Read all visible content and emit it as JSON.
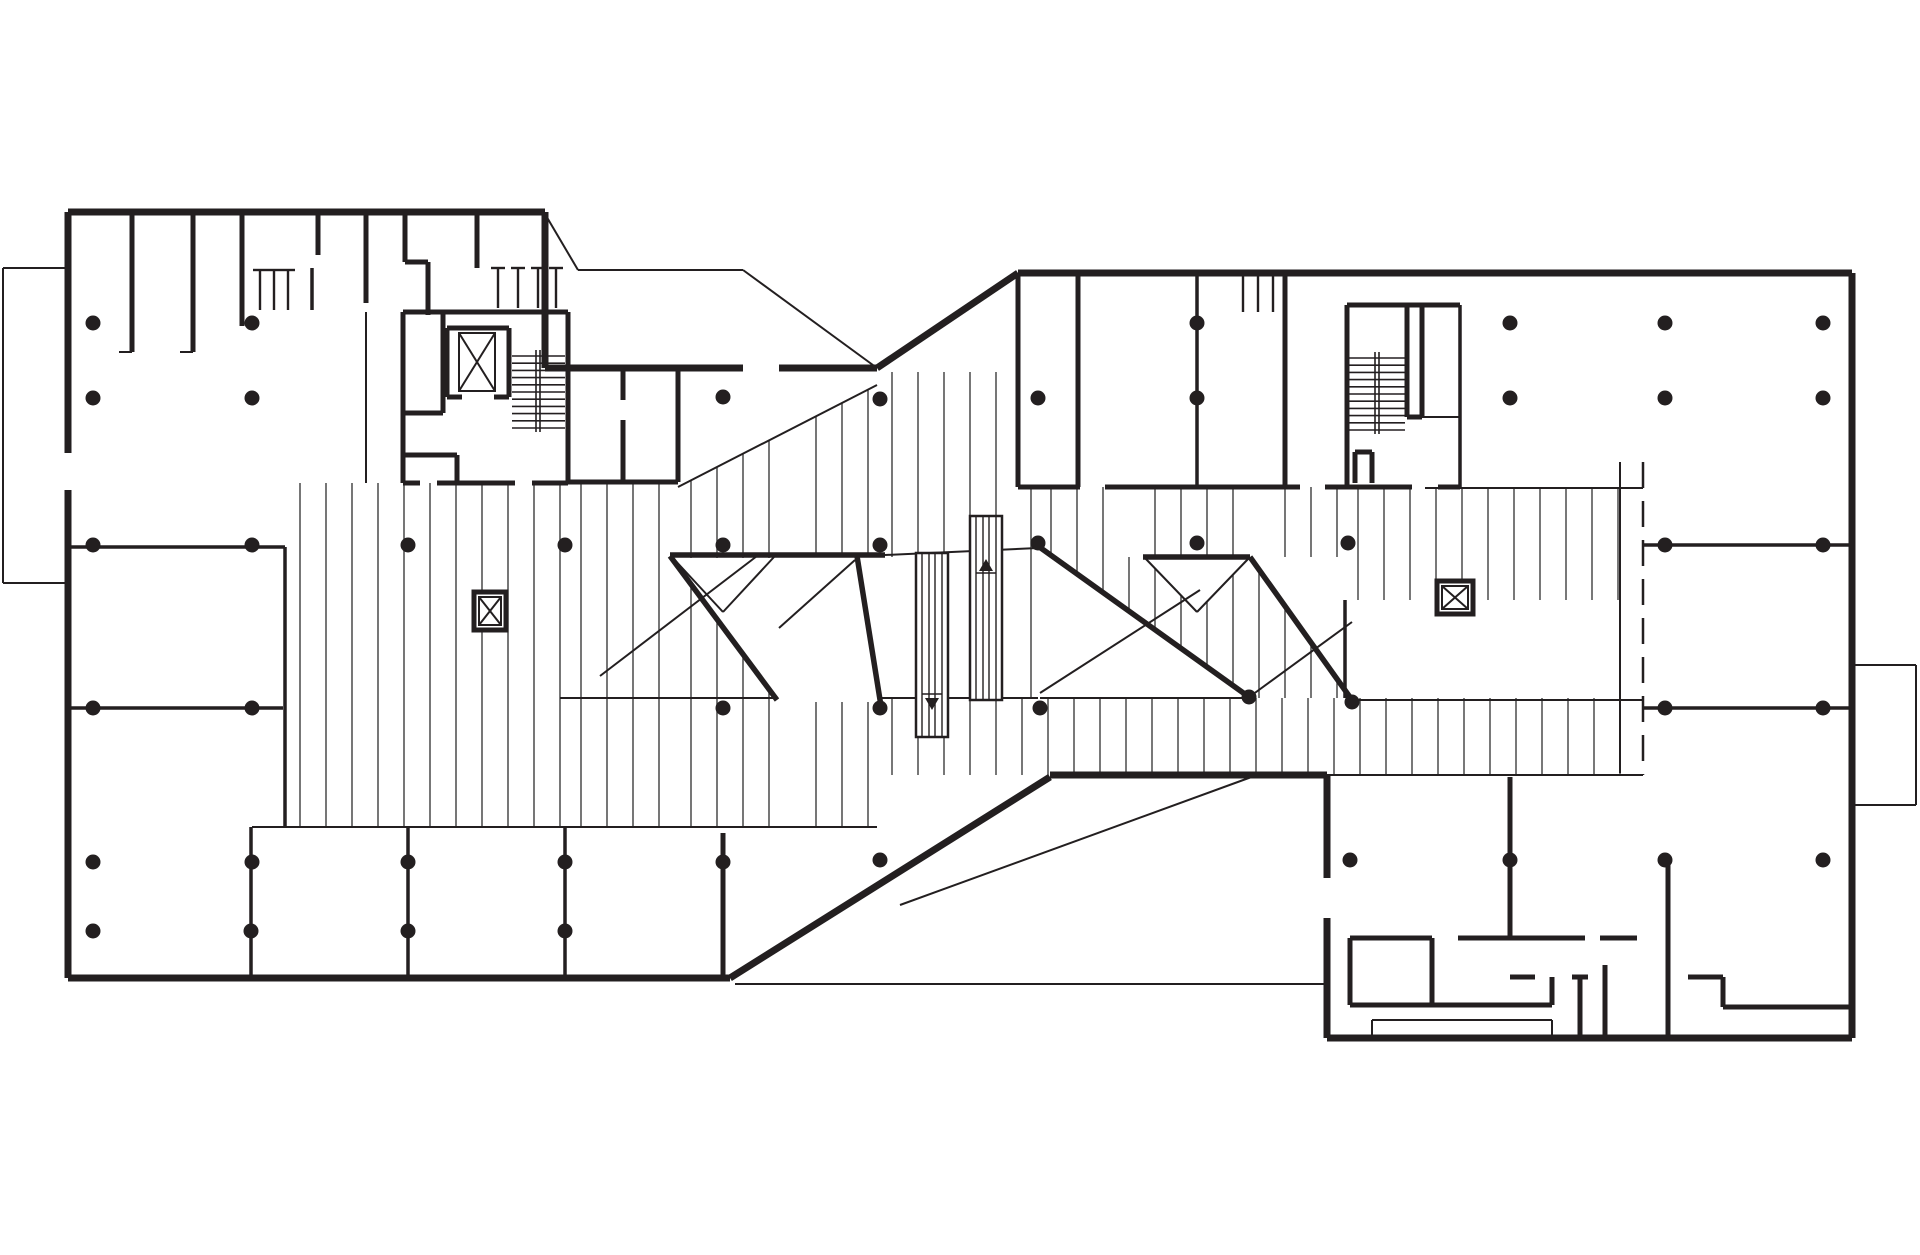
{
  "meta": {
    "title": "Building floor plan — parking level with ramp bands, two stair cores and service annex",
    "canvas": {
      "w": 1920,
      "h": 1255
    },
    "ink": "#231f20",
    "hatch_ink": "#3d3d3d",
    "bg": "#ffffff"
  },
  "plan": {
    "walls_thick": [
      [
        68,
        212,
        545,
        212
      ],
      [
        545,
        212,
        545,
        368
      ],
      [
        545,
        368,
        743,
        368
      ],
      [
        779,
        368,
        877,
        368
      ],
      [
        877,
        368,
        1018,
        273
      ],
      [
        1018,
        273,
        1852,
        273
      ],
      [
        1852,
        273,
        1852,
        1038
      ],
      [
        1327,
        1038,
        1852,
        1038
      ],
      [
        1327,
        918,
        1327,
        1038
      ],
      [
        1327,
        775,
        1327,
        878
      ],
      [
        1050,
        775,
        1327,
        775
      ],
      [
        730,
        978,
        1050,
        777
      ],
      [
        68,
        978,
        730,
        978
      ],
      [
        68,
        490,
        68,
        978
      ],
      [
        68,
        212,
        68,
        453
      ]
    ],
    "walls_medium": [
      [
        132,
        212,
        132,
        352
      ],
      [
        193,
        212,
        193,
        352
      ],
      [
        242,
        212,
        242,
        326
      ],
      [
        318,
        212,
        318,
        255
      ],
      [
        366,
        212,
        366,
        303
      ],
      [
        405,
        212,
        405,
        262
      ],
      [
        405,
        262,
        428,
        262
      ],
      [
        428,
        262,
        428,
        315
      ],
      [
        477,
        212,
        477,
        268
      ],
      [
        403,
        312,
        568,
        312
      ],
      [
        403,
        312,
        403,
        483
      ],
      [
        568,
        312,
        568,
        483
      ],
      [
        403,
        483,
        420,
        483
      ],
      [
        437,
        483,
        515,
        483
      ],
      [
        532,
        483,
        568,
        483
      ],
      [
        443,
        312,
        443,
        413
      ],
      [
        403,
        413,
        443,
        413
      ],
      [
        447,
        328,
        509,
        328
      ],
      [
        447,
        328,
        447,
        397
      ],
      [
        509,
        328,
        509,
        397
      ],
      [
        447,
        397,
        462,
        397
      ],
      [
        494,
        397,
        509,
        397
      ],
      [
        403,
        455,
        457,
        455
      ],
      [
        457,
        455,
        457,
        483
      ],
      [
        678,
        368,
        678,
        482
      ],
      [
        623,
        368,
        623,
        400
      ],
      [
        623,
        420,
        623,
        482
      ],
      [
        568,
        482,
        678,
        482
      ],
      [
        723,
        833,
        723,
        978
      ],
      [
        1018,
        273,
        1018,
        487
      ],
      [
        1078,
        273,
        1078,
        487
      ],
      [
        1018,
        487,
        1080,
        487
      ],
      [
        1105,
        487,
        1300,
        487
      ],
      [
        1325,
        487,
        1412,
        487
      ],
      [
        1438,
        487,
        1460,
        487
      ],
      [
        1285,
        273,
        1285,
        487
      ],
      [
        1347,
        305,
        1460,
        305
      ],
      [
        1347,
        305,
        1347,
        487
      ],
      [
        1407,
        305,
        1407,
        417
      ],
      [
        1407,
        417,
        1422,
        417
      ],
      [
        1422,
        305,
        1422,
        417
      ],
      [
        1355,
        452,
        1355,
        483
      ],
      [
        1355,
        452,
        1372,
        452
      ],
      [
        1372,
        452,
        1372,
        483
      ],
      [
        1510,
        777,
        1510,
        938
      ],
      [
        1350,
        938,
        1432,
        938
      ],
      [
        1458,
        938,
        1585,
        938
      ],
      [
        1600,
        938,
        1637,
        938
      ],
      [
        1350,
        938,
        1350,
        1005
      ],
      [
        1432,
        938,
        1432,
        1005
      ],
      [
        1350,
        1005,
        1552,
        1005
      ],
      [
        1552,
        977,
        1552,
        1005
      ],
      [
        1510,
        977,
        1535,
        977
      ],
      [
        1580,
        977,
        1580,
        1038
      ],
      [
        1572,
        977,
        1588,
        977
      ],
      [
        1605,
        965,
        1605,
        1038
      ],
      [
        1668,
        858,
        1668,
        1038
      ],
      [
        1688,
        977,
        1723,
        977
      ],
      [
        1723,
        977,
        1723,
        1007
      ],
      [
        1723,
        1007,
        1852,
        1007
      ]
    ],
    "ramps_thick": [
      [
        670,
        555,
        885,
        555
      ],
      [
        1143,
        557,
        1250,
        557
      ],
      [
        670,
        556,
        777,
        700
      ],
      [
        857,
        556,
        881,
        706
      ],
      [
        1038,
        546,
        1249,
        697
      ],
      [
        1250,
        557,
        1352,
        700
      ]
    ],
    "walls_light": [
      [
        68,
        547,
        285,
        547
      ],
      [
        285,
        547,
        285,
        827
      ],
      [
        68,
        708,
        283,
        708
      ],
      [
        1643,
        545,
        1852,
        545
      ],
      [
        1643,
        708,
        1852,
        708
      ],
      [
        251,
        827,
        251,
        978
      ],
      [
        408,
        827,
        408,
        978
      ],
      [
        565,
        827,
        565,
        978
      ],
      [
        1197,
        273,
        1197,
        487
      ],
      [
        1460,
        305,
        1460,
        487
      ],
      [
        312,
        268,
        312,
        310
      ],
      [
        1345,
        600,
        1345,
        698
      ]
    ],
    "lines_thin": [
      [
        545,
        214,
        578,
        270
      ],
      [
        578,
        270,
        743,
        270
      ],
      [
        743,
        270,
        877,
        368
      ],
      [
        678,
        487,
        877,
        385
      ],
      [
        885,
        555,
        1038,
        548
      ],
      [
        560,
        698,
        777,
        698
      ],
      [
        879,
        698,
        1038,
        698
      ],
      [
        1040,
        698,
        1248,
        698
      ],
      [
        1352,
        700,
        1643,
        700
      ],
      [
        1327,
        775,
        1643,
        775
      ],
      [
        252,
        827,
        877,
        827
      ],
      [
        1425,
        488,
        1643,
        488
      ],
      [
        1620,
        462,
        1620,
        773
      ],
      [
        3,
        268,
        68,
        268
      ],
      [
        3,
        268,
        3,
        583
      ],
      [
        3,
        583,
        68,
        583
      ],
      [
        1852,
        665,
        1916,
        665
      ],
      [
        1916,
        665,
        1916,
        805
      ],
      [
        1852,
        805,
        1916,
        805
      ],
      [
        735,
        984,
        1327,
        984
      ],
      [
        900,
        905,
        1257,
        775
      ],
      [
        119,
        352,
        132,
        352
      ],
      [
        180,
        352,
        193,
        352
      ],
      [
        600,
        676,
        757,
        556
      ],
      [
        779,
        628,
        855,
        560
      ],
      [
        672,
        557,
        723,
        612
      ],
      [
        723,
        612,
        774,
        557
      ],
      [
        1040,
        693,
        1200,
        590
      ],
      [
        1252,
        695,
        1352,
        622
      ],
      [
        1145,
        558,
        1197,
        612
      ],
      [
        1197,
        612,
        1249,
        558
      ],
      [
        1372,
        1020,
        1552,
        1020
      ],
      [
        1372,
        1020,
        1372,
        1036
      ],
      [
        1552,
        1020,
        1552,
        1036
      ],
      [
        1372,
        1036,
        1552,
        1036
      ],
      [
        366,
        312,
        366,
        483
      ],
      [
        1422,
        417,
        1460,
        417
      ]
    ],
    "dashed": [
      [
        1643,
        462,
        1643,
        775
      ]
    ],
    "hatch_regions": [
      [
        287,
        483,
        568,
        827
      ],
      [
        568,
        483,
        678,
        827
      ],
      [
        678,
        372,
        777,
        827
      ],
      [
        803,
        372,
        877,
        827
      ],
      [
        879,
        372,
        1018,
        557
      ],
      [
        1018,
        487,
        1038,
        698
      ],
      [
        1038,
        487,
        1345,
        698
      ],
      [
        1345,
        487,
        1643,
        600
      ],
      [
        879,
        698,
        1643,
        775
      ]
    ],
    "white_rects": [
      [
        777,
        557,
        803,
        827
      ],
      [
        1118,
        487,
        1145,
        557
      ],
      [
        1235,
        487,
        1275,
        560
      ],
      [
        1345,
        600,
        1643,
        698
      ]
    ],
    "white_polys": [
      [
        [
          678,
          368
        ],
        [
          877,
          368
        ],
        [
          877,
          385
        ],
        [
          678,
          487
        ]
      ],
      [
        [
          672,
          558
        ],
        [
          777,
          558
        ],
        [
          777,
          697
        ]
      ],
      [
        [
          803,
          557
        ],
        [
          881,
          557
        ],
        [
          881,
          702
        ],
        [
          803,
          702
        ]
      ],
      [
        [
          1038,
          546
        ],
        [
          1249,
          697
        ],
        [
          1038,
          697
        ]
      ],
      [
        [
          1250,
          557
        ],
        [
          1352,
          557
        ],
        [
          1352,
          700
        ]
      ],
      [
        [
          1143,
          557
        ],
        [
          1250,
          557
        ],
        [
          1197,
          612
        ]
      ]
    ],
    "stairs": [
      {
        "treads": {
          "x1": 512,
          "x2": 565,
          "y0": 356,
          "dy": 7.2,
          "n": 11
        },
        "stringers": [
          [
            536,
            350,
            536,
            432
          ],
          [
            540,
            350,
            540,
            432
          ]
        ]
      },
      {
        "treads": {
          "x1": 1349,
          "x2": 1405,
          "y0": 358,
          "dy": 7.2,
          "n": 11
        },
        "stringers": [
          [
            1375,
            352,
            1375,
            434
          ],
          [
            1379,
            352,
            1379,
            434
          ]
        ]
      }
    ],
    "shaft_boxes": [
      [
        474,
        592,
        506,
        630
      ],
      [
        1437,
        581,
        1473,
        614
      ]
    ],
    "elevator_x_boxes": [
      [
        459,
        333,
        495,
        391
      ],
      [
        479,
        597,
        501,
        625
      ],
      [
        1442,
        586,
        1468,
        609
      ]
    ],
    "escalator_shafts": [
      {
        "outer": [
          916,
          553,
          948,
          737
        ],
        "inner_x": [
          922,
          929,
          935,
          942
        ],
        "tick_y": 694,
        "tri": [
          [
            925,
            698
          ],
          [
            939,
            698
          ],
          [
            932,
            710
          ]
        ]
      },
      {
        "outer": [
          970,
          516,
          1002,
          700
        ],
        "inner_x": [
          976,
          983,
          989,
          996
        ],
        "tick_y": 573,
        "tri": [
          [
            979,
            571
          ],
          [
            993,
            571
          ],
          [
            986,
            559
          ]
        ]
      }
    ],
    "combs": [
      {
        "xs": [
          260,
          274,
          288
        ],
        "y1": 270,
        "y2": 310
      },
      {
        "xs": [
          498,
          518,
          538,
          556
        ],
        "y1": 268,
        "y2": 308
      },
      {
        "xs": [
          1243,
          1258,
          1273
        ],
        "y1": 275,
        "y2": 312
      }
    ],
    "columns": [
      [
        93,
        323
      ],
      [
        252,
        323
      ],
      [
        1197,
        323
      ],
      [
        1510,
        323
      ],
      [
        1665,
        323
      ],
      [
        1823,
        323
      ],
      [
        93,
        398
      ],
      [
        252,
        398
      ],
      [
        723,
        397
      ],
      [
        880,
        399
      ],
      [
        1038,
        398
      ],
      [
        1197,
        398
      ],
      [
        1510,
        398
      ],
      [
        1665,
        398
      ],
      [
        1823,
        398
      ],
      [
        93,
        545
      ],
      [
        252,
        545
      ],
      [
        408,
        545
      ],
      [
        565,
        545
      ],
      [
        723,
        545
      ],
      [
        880,
        545
      ],
      [
        1038,
        543
      ],
      [
        1197,
        543
      ],
      [
        1348,
        543
      ],
      [
        1665,
        545
      ],
      [
        1823,
        545
      ],
      [
        93,
        708
      ],
      [
        252,
        708
      ],
      [
        723,
        708
      ],
      [
        880,
        708
      ],
      [
        1040,
        708
      ],
      [
        1249,
        697
      ],
      [
        1352,
        702
      ],
      [
        1665,
        708
      ],
      [
        1823,
        708
      ],
      [
        93,
        862
      ],
      [
        252,
        862
      ],
      [
        408,
        862
      ],
      [
        565,
        862
      ],
      [
        723,
        862
      ],
      [
        880,
        860
      ],
      [
        1350,
        860
      ],
      [
        1510,
        860
      ],
      [
        1665,
        860
      ],
      [
        1823,
        860
      ],
      [
        93,
        931
      ],
      [
        251,
        931
      ],
      [
        408,
        931
      ],
      [
        565,
        931
      ]
    ],
    "hatch_spacing": 26,
    "column_radius": 7.5,
    "stroke": {
      "thick": 7,
      "medium": 5,
      "ramp": 5.5,
      "light": 3.5,
      "thin": 2,
      "hatch": 1.4
    }
  }
}
